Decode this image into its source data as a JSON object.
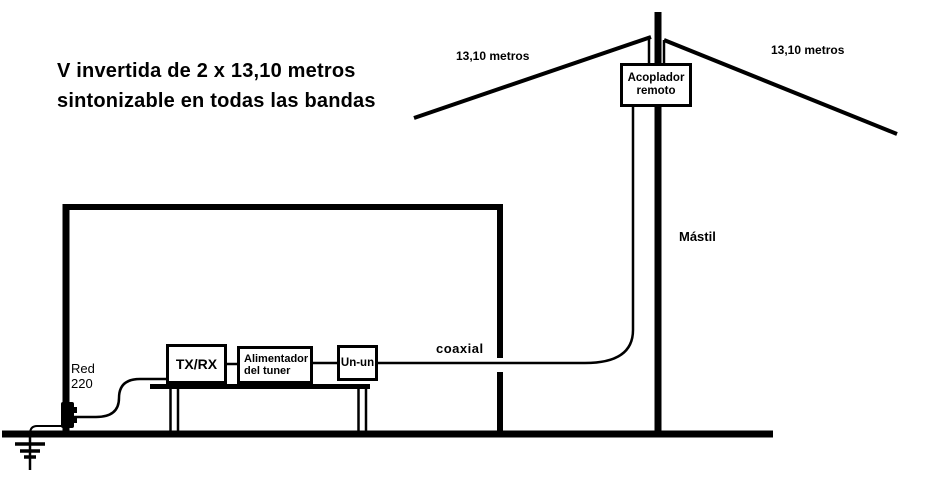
{
  "diagram": {
    "title_line1": "V invertida de 2 x 13,10 metros",
    "title_line2": "sintonizable en todas las bandas",
    "antenna": {
      "left_wire_label": "13,10 metros",
      "right_wire_label": "13,10 metros",
      "mast_label": "Mástil",
      "coupler_line1": "Acoplador",
      "coupler_line2": "remoto"
    },
    "station": {
      "transceiver_label": "TX/RX",
      "feeder_line1": "Alimentador",
      "feeder_line2": "del tuner",
      "balun_label": "Un-un",
      "coax_label": "coaxial",
      "power_line1": "Red",
      "power_line2": "220"
    },
    "colors": {
      "ink": "#000000",
      "background": "#ffffff"
    }
  }
}
